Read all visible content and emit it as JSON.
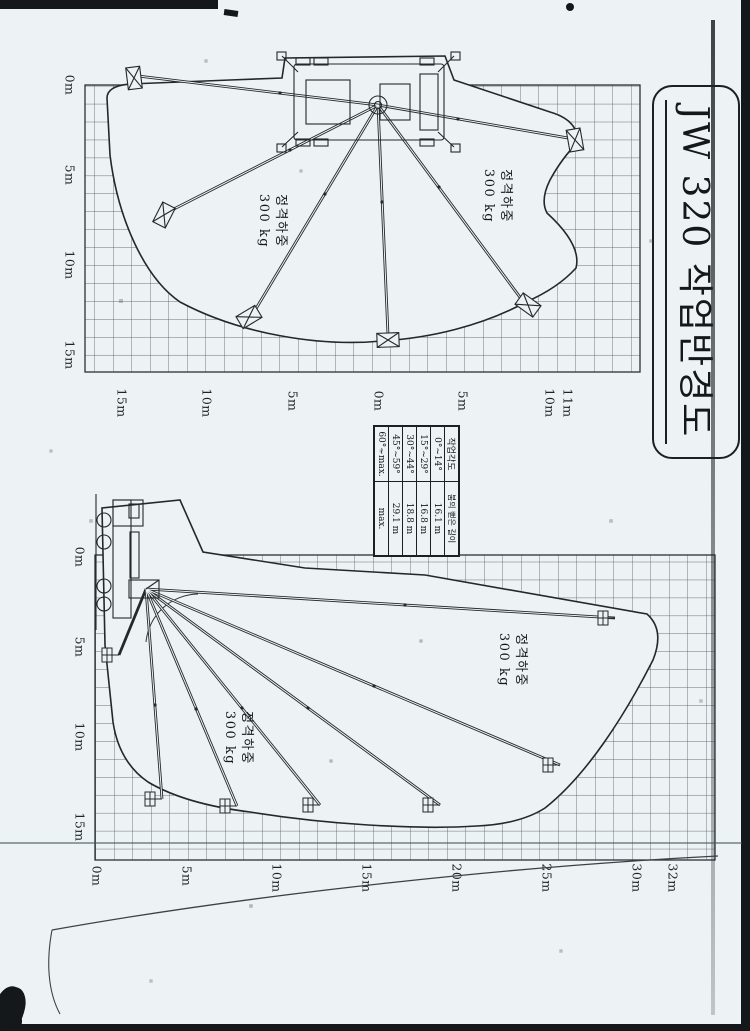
{
  "title": "JW 320 작업반경도",
  "rated_load": {
    "line1": "정격하중",
    "line2": "300 kg"
  },
  "angle_table": {
    "col_headers": [
      "작업각도",
      "붐의 뻗은 길이"
    ],
    "rows": [
      {
        "angle": "0°~14°",
        "length": "16.1 m"
      },
      {
        "angle": "15°~29°",
        "length": "16.8 m"
      },
      {
        "angle": "30°~44°",
        "length": "18.8 m"
      },
      {
        "angle": "45°~59°",
        "length": "29.1 m"
      },
      {
        "angle": "60°~max.",
        "length": "max."
      }
    ]
  },
  "plan_chart": {
    "bottom_axis": [
      "0m",
      "5m",
      "10m",
      "15m"
    ],
    "right_axis": [
      "11m",
      "10m",
      "5m",
      "0m",
      "5m",
      "10m",
      "15m"
    ]
  },
  "elevation_chart": {
    "bottom_axis": [
      "0m",
      "5m",
      "10m",
      "15m"
    ],
    "right_axis": [
      "32m",
      "30m",
      "25m",
      "20m",
      "15m",
      "10m",
      "5m",
      "0m"
    ]
  },
  "chart_data": [
    {
      "type": "diagram",
      "title": "JW 320 작업반경도 — 평면도 (plan view)",
      "rated_load": "정격하중 300 kg",
      "grid": "1 m squares",
      "x_axis_ticks": [
        "0m",
        "5m",
        "10m",
        "15m"
      ],
      "radial_axis_ticks": [
        "11m",
        "10m",
        "5m",
        "0m",
        "5m",
        "10m",
        "15m"
      ],
      "boom_positions_deg": [
        -97,
        -63,
        -31,
        -2,
        36,
        80
      ],
      "reach_m": {
        "up": 11,
        "right": 14,
        "down": 15
      }
    },
    {
      "type": "diagram",
      "title": "JW 320 작업반경도 — 측면도 (elevation view)",
      "rated_load": "정격하중 300 kg",
      "grid": "1 m squares",
      "x_axis_ticks": [
        "0m",
        "5m",
        "10m",
        "15m"
      ],
      "y_axis_ticks": [
        "0m",
        "5m",
        "10m",
        "15m",
        "20m",
        "25m",
        "30m",
        "32m"
      ],
      "boom_tip_points_m": [
        [
          13.6,
          3.7
        ],
        [
          14.0,
          7.9
        ],
        [
          13.9,
          12.5
        ],
        [
          13.9,
          19.2
        ],
        [
          11.7,
          25.8
        ],
        [
          3.5,
          28.9
        ]
      ],
      "max_height_m": 32
    },
    {
      "type": "table",
      "columns": [
        "작업각도",
        "붐의 뻗은 길이"
      ],
      "rows": [
        [
          "0°~14°",
          "16.1 m"
        ],
        [
          "15°~29°",
          "16.8 m"
        ],
        [
          "30°~44°",
          "18.8 m"
        ],
        [
          "45°~59°",
          "29.1 m"
        ],
        [
          "60°~max.",
          "max."
        ]
      ]
    }
  ]
}
